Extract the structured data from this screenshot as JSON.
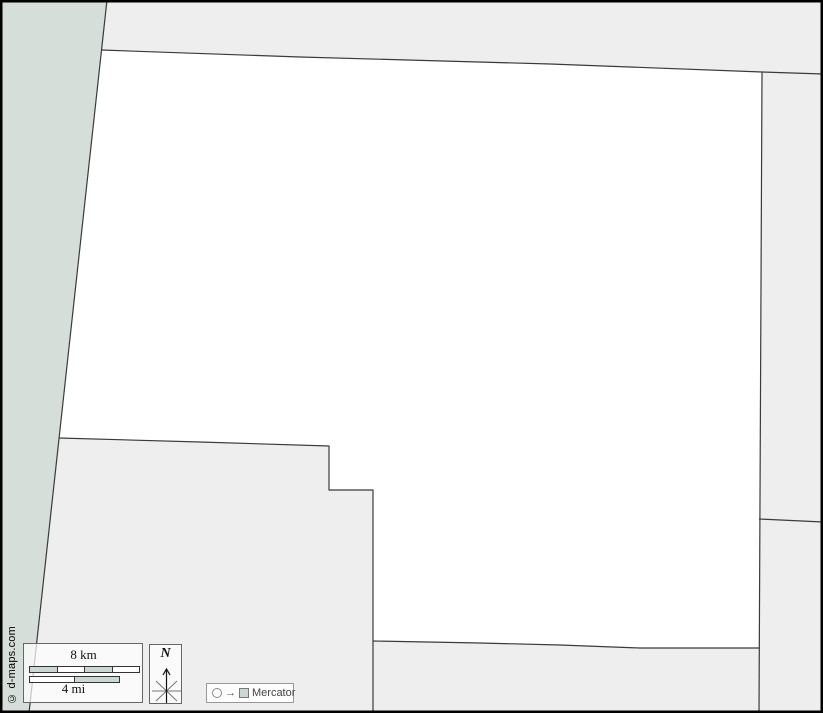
{
  "map": {
    "attribution": "© d-maps.com",
    "projection": {
      "label": "Mercator"
    },
    "compass": {
      "north_label": "N"
    },
    "scale": {
      "km_label": "8 km",
      "mi_label": "4 mi"
    },
    "colors": {
      "water_band": "#d5ded9",
      "neighbor_region": "#eeeeee",
      "main_region": "#ffffff",
      "border_line": "#3a3a3a",
      "frame": "#000000",
      "scale_segment": "#ccd7d2"
    }
  }
}
